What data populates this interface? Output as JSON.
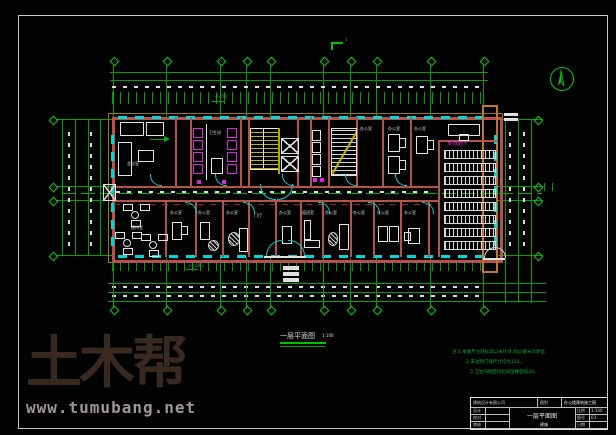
{
  "watermark": {
    "brand": "土木帮",
    "url": "www.tumubang.net"
  },
  "drawing": {
    "title": "一层平面图",
    "scale": "1:100",
    "section_marker": "1"
  },
  "colors": {
    "grid_green": "#00a000",
    "wall_red": "#b5524a",
    "window_cyan": "#00d8d8",
    "fixture_magenta": "#e020e0",
    "stair_yellow": "#c2b400",
    "accent_orange": "#c07828"
  },
  "annotations": {
    "elev_top": "-0.450",
    "elev_bottom": "±0.000"
  },
  "rooms": [
    {
      "name": "会议室"
    },
    {
      "name": "卫生间"
    },
    {
      "name": "办公室"
    },
    {
      "name": "办公室"
    },
    {
      "name": "办公室"
    },
    {
      "name": "多功能厅"
    },
    {
      "name": "接待室"
    },
    {
      "name": "办公室"
    },
    {
      "name": "办公室"
    },
    {
      "name": "办公室"
    },
    {
      "name": "门厅"
    },
    {
      "name": "办公室"
    },
    {
      "name": "值班室"
    },
    {
      "name": "办公室"
    },
    {
      "name": "办公室"
    },
    {
      "name": "办公室"
    },
    {
      "name": "办公室"
    }
  ],
  "notes": [
    "注:1.本图尺寸除标高以米计外,均以毫米为单位;",
    "2.未注明门垛尺寸均为120。",
    "3.卫生间地面均比同层楼面低20。"
  ],
  "titleblock": {
    "company": "建筑设计有限公司",
    "stage_label": "图别",
    "stage": "建施",
    "project": "办公楼建筑施工图",
    "drawing_name": "一层平面图",
    "row1": "设计",
    "row2": "校对",
    "row3": "审核",
    "scale_label": "比例",
    "scale": "1:100",
    "no_label": "图号",
    "no": "03",
    "date_label": "日期"
  }
}
